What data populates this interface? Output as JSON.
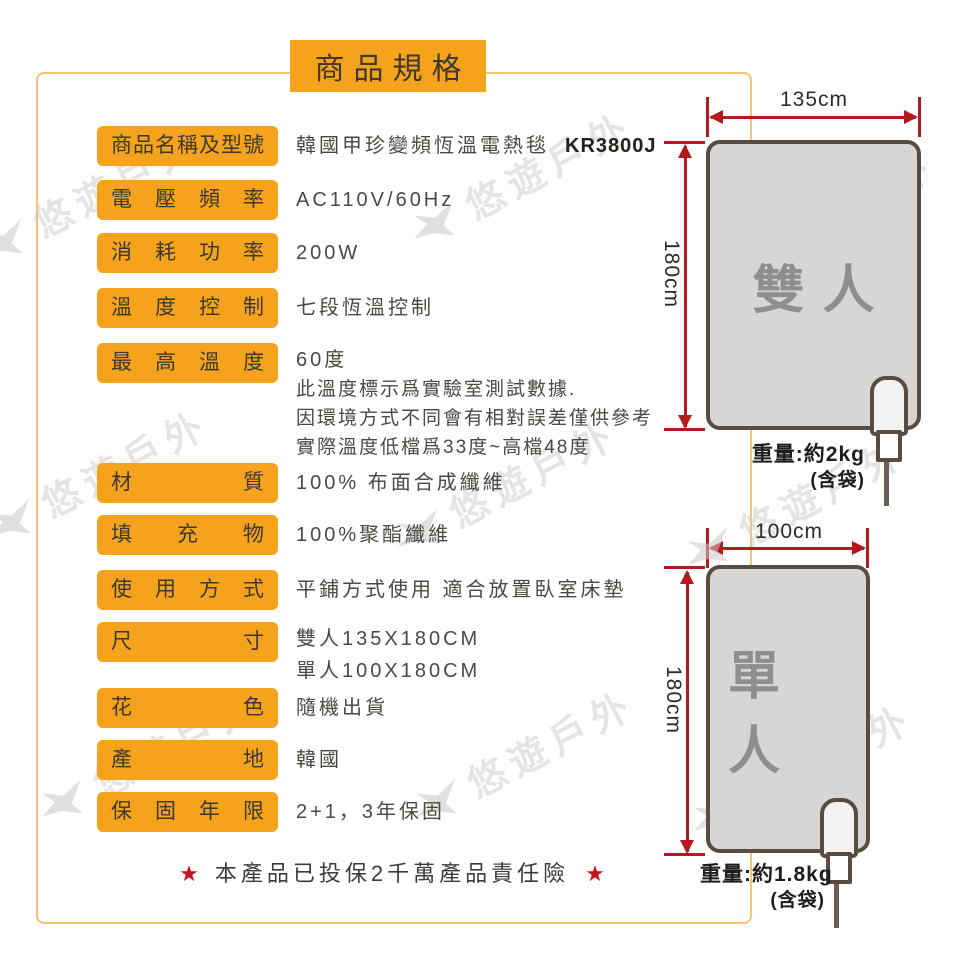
{
  "page": {
    "title": "商品規格",
    "footer_star": "★",
    "footer_note": "本產品已投保2千萬產品責任險"
  },
  "specs": {
    "rows": [
      {
        "label": "商品名稱及型號",
        "value": "韓國甲珍變頻恆溫電熱毯",
        "value_bold": "KR3800J"
      },
      {
        "label": "電壓頻率",
        "value": "AC110V/60Hz"
      },
      {
        "label": "消耗功率",
        "value": "200W"
      },
      {
        "label": "溫度控制",
        "value": "七段恆溫控制"
      },
      {
        "label": "最高溫度",
        "value": "60度",
        "notes": [
          "此溫度標示爲實驗室測試數據.",
          "因環境方式不同會有相對誤差僅供參考",
          "實際溫度低檔爲33度~高檔48度"
        ]
      },
      {
        "label": "材質",
        "value": "100% 布面合成纖維"
      },
      {
        "label": "填充物",
        "value": "100%聚酯纖維"
      },
      {
        "label": "使用方式",
        "value": "平鋪方式使用 適合放置臥室床墊"
      },
      {
        "label": "尺寸",
        "value": "雙人135X180CM",
        "value2": "單人100X180CM"
      },
      {
        "label": "花色",
        "value": "隨機出貨"
      },
      {
        "label": "產地",
        "value": "韓國"
      },
      {
        "label": "保固年限",
        "value": "2+1，3年保固"
      }
    ]
  },
  "diagrams": {
    "double": {
      "name": "雙人",
      "width_label": "135cm",
      "height_label": "180cm",
      "weight": "重量:約2kg",
      "weight_note": "(含袋)"
    },
    "single": {
      "name": "單人",
      "width_label": "100cm",
      "height_label": "180cm",
      "weight": "重量:約1.8kg",
      "weight_note": "(含袋)"
    }
  },
  "watermark": {
    "text": "悠遊戶外"
  },
  "colors": {
    "accent_orange": "#f5a21d",
    "frame_orange": "#f7c36f",
    "dimension_red": "#b5181e",
    "blanket_fill": "#d7d6d4",
    "blanket_border": "#584c41",
    "blanket_label_gray": "#8f8e8c",
    "star_red": "#c3161c"
  }
}
